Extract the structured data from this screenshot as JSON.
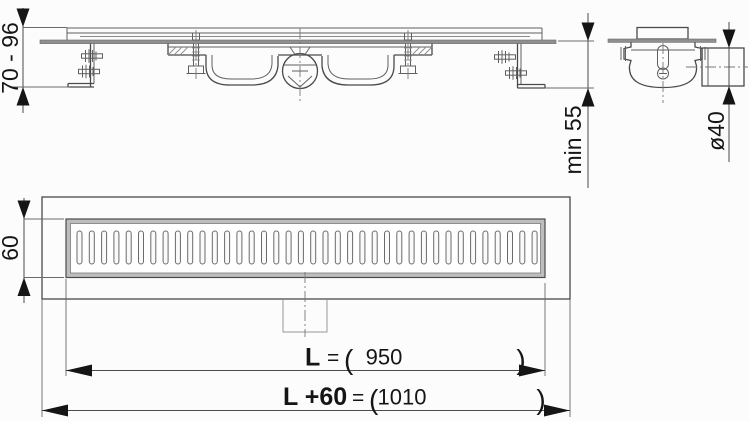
{
  "drawing_type": "shower-drain-channel-technical-drawing",
  "colors": {
    "background": "#fcfcfc",
    "line": "#4a4a4a",
    "plate_fill": "#8f8f8f",
    "frame_band_fill": "#bdbdbd",
    "arrow": "#151515",
    "text": "#151515"
  },
  "labels": {
    "height_range": "70 - 96",
    "min_depth": "min 55",
    "pipe_diameter": "ø40",
    "grate_width": "60",
    "length": {
      "label": "L",
      "eq": "=",
      "open": "(",
      "value": "950",
      "close": ")"
    },
    "total_length": {
      "label": "L +60",
      "eq": "=",
      "open": "(",
      "value": "1010",
      "close": ")"
    }
  },
  "grate": {
    "slot_count": 38,
    "x0": 77,
    "pitch": 12.3,
    "y": 231,
    "width": 5,
    "height": 33,
    "rx": 2.5
  }
}
